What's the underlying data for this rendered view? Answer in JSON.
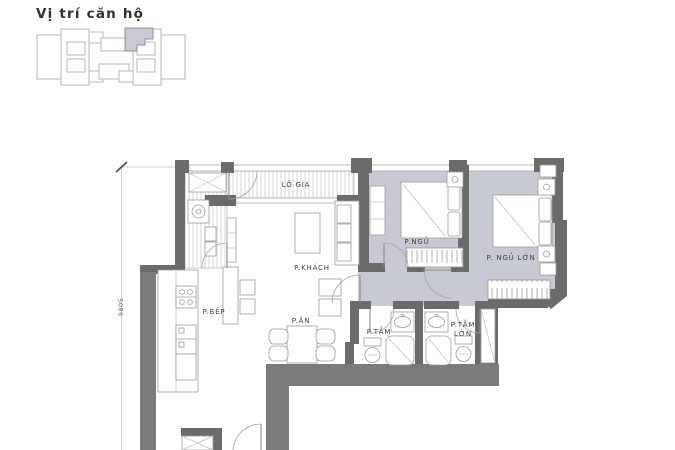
{
  "title": "Vị trí căn hộ",
  "dimension_label": "9805",
  "rooms": {
    "lo_gia": "LÔ GIA",
    "p_khach": "P.KHÁCH",
    "p_ngu": "P.NGỦ",
    "p_ngu_lon": "P. NGỦ LỚN",
    "p_bep": "P.BẾP",
    "p_an": "P.ĂN",
    "p_tam": "P.TẮM",
    "p_tam_lon": "P.TẮM\nLỚN"
  },
  "colors": {
    "wall_dark": "#6b6b6b",
    "wall_light": "#7b7b7b",
    "bedroom_floor": "#c7cad2",
    "highlighted_unit": "#c7cbd4",
    "outline": "#9c9c9c",
    "text": "#3f3f3f"
  }
}
